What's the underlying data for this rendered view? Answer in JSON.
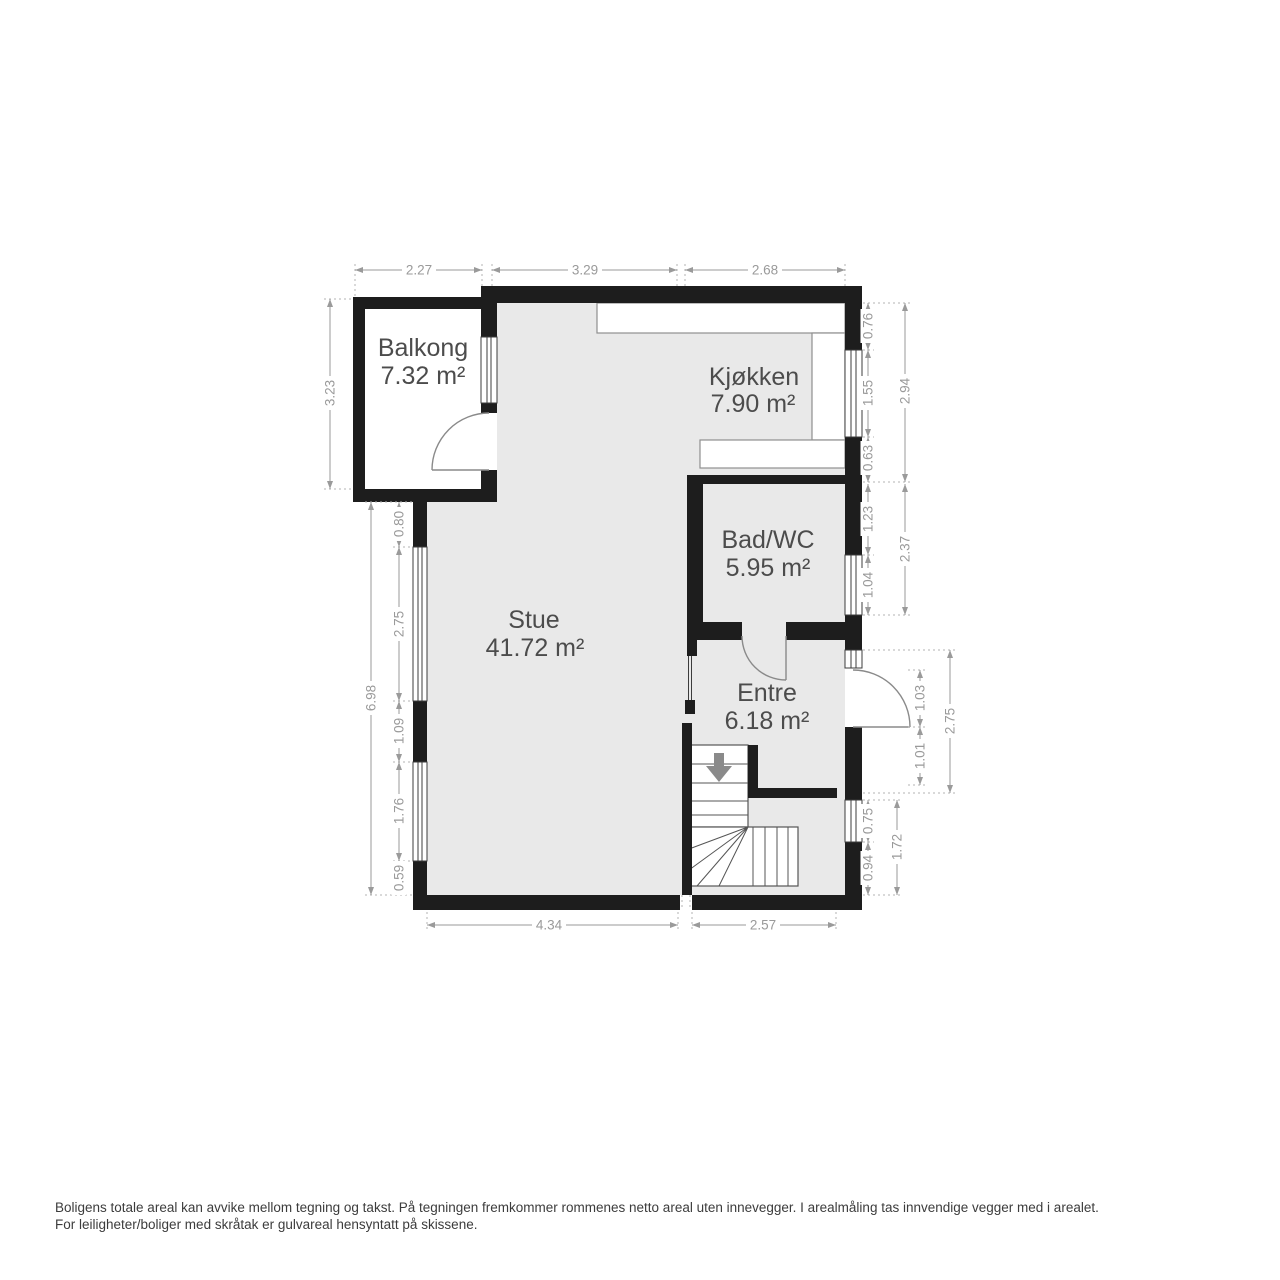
{
  "rooms": [
    {
      "name": "Balkong",
      "area": "7.32 m²"
    },
    {
      "name": "Kjøkken",
      "area": "7.90 m²"
    },
    {
      "name": "Bad/WC",
      "area": "5.95 m²"
    },
    {
      "name": "Stue",
      "area": "41.72 m²"
    },
    {
      "name": "Entre",
      "area": "6.18 m²"
    }
  ],
  "dims": {
    "top": [
      "2.27",
      "3.29",
      "2.68"
    ],
    "bottom": [
      "4.34",
      "2.57"
    ],
    "left": {
      "balcony_height": "3.23",
      "total": "6.98",
      "chain": [
        "0.80",
        "2.75",
        "1.09",
        "1.76",
        "0.59"
      ]
    },
    "right": {
      "kitchen_chain": [
        "0.76",
        "1.55",
        "0.63"
      ],
      "kitchen_total": "2.94",
      "bath_chain": [
        "1.23",
        "1.04"
      ],
      "bath_total": "2.37",
      "door_chain": [
        "1.03",
        "1.01"
      ],
      "door_total": "2.75",
      "bottom_chain": [
        "0.75",
        "0.94"
      ],
      "bottom_total": "1.72"
    }
  },
  "icons": {
    "stairs_direction": "stairs-down-arrow-icon"
  },
  "colors": {
    "background": "#ffffff",
    "wall": "#1d1d1d",
    "room_fill": "#e9e9e9",
    "dimension": "#9a9a9a",
    "room_label": "#4c4c4c",
    "stair_arrow": "#8a8a8a",
    "footer_text": "#3c3c3c"
  },
  "footer": {
    "line1": "Boligens totale areal kan avvike mellom tegning og takst. På tegningen fremkommer rommenes netto areal uten innevegger. I arealmåling tas innvendige vegger med i arealet.",
    "line2": "For leiligheter/boliger med skråtak er gulvareal hensyntatt på skissene."
  }
}
